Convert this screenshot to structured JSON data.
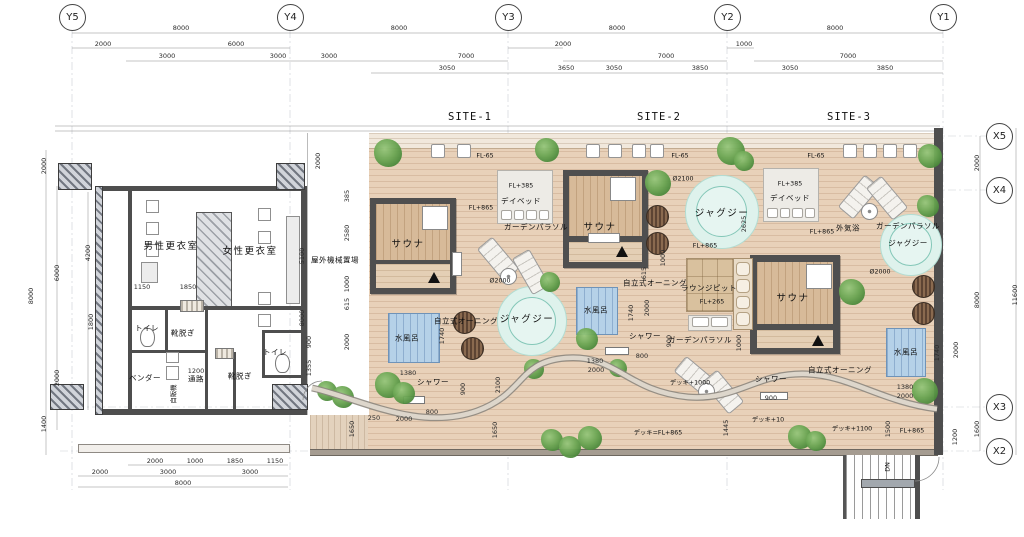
{
  "colors": {
    "deck": "#e8d1b9",
    "wall": "#4e4e4e",
    "pool": "#b5d1e8",
    "jacuzzi": "#def2ec",
    "tree": "#5d9a47",
    "path": "#8d877f",
    "accent_wood": "#d7ba99"
  },
  "grid": {
    "y_axes": [
      {
        "label": "Y5",
        "x": 72
      },
      {
        "label": "Y4",
        "x": 290
      },
      {
        "label": "Y3",
        "x": 508
      },
      {
        "label": "Y2",
        "x": 727
      },
      {
        "label": "Y1",
        "x": 943
      }
    ],
    "x_axes": [
      {
        "label": "X5",
        "y": 136
      },
      {
        "label": "X4",
        "y": 190
      },
      {
        "label": "X3",
        "y": 407
      },
      {
        "label": "X2",
        "y": 451
      }
    ]
  },
  "sites": [
    {
      "label": "SITE-1",
      "x": 470,
      "y": 117
    },
    {
      "label": "SITE-2",
      "x": 659,
      "y": 117
    },
    {
      "label": "SITE-3",
      "x": 849,
      "y": 117
    }
  ],
  "dims": [
    {
      "t": "8000",
      "x": 181,
      "y": 28
    },
    {
      "t": "8000",
      "x": 399,
      "y": 28
    },
    {
      "t": "8000",
      "x": 617,
      "y": 28
    },
    {
      "t": "8000",
      "x": 835,
      "y": 28
    },
    {
      "t": "2000",
      "x": 103,
      "y": 44
    },
    {
      "t": "6000",
      "x": 236,
      "y": 44
    },
    {
      "t": "2000",
      "x": 563,
      "y": 44
    },
    {
      "t": "1000",
      "x": 744,
      "y": 44
    },
    {
      "t": "3000",
      "x": 167,
      "y": 56
    },
    {
      "t": "3000",
      "x": 278,
      "y": 56
    },
    {
      "t": "3000",
      "x": 329,
      "y": 56
    },
    {
      "t": "7000",
      "x": 466,
      "y": 56
    },
    {
      "t": "7000",
      "x": 666,
      "y": 56
    },
    {
      "t": "7000",
      "x": 848,
      "y": 56
    },
    {
      "t": "3050",
      "x": 447,
      "y": 68
    },
    {
      "t": "3650",
      "x": 566,
      "y": 68
    },
    {
      "t": "3050",
      "x": 614,
      "y": 68
    },
    {
      "t": "3850",
      "x": 700,
      "y": 68
    },
    {
      "t": "3050",
      "x": 790,
      "y": 68
    },
    {
      "t": "3850",
      "x": 885,
      "y": 68
    },
    {
      "t": "2000",
      "x": 44,
      "y": 166,
      "r": 1
    },
    {
      "t": "6000",
      "x": 57,
      "y": 273,
      "r": 1
    },
    {
      "t": "8000",
      "x": 31,
      "y": 296,
      "r": 1
    },
    {
      "t": "2000",
      "x": 57,
      "y": 378,
      "r": 1
    },
    {
      "t": "1400",
      "x": 44,
      "y": 424,
      "r": 1
    },
    {
      "t": "4200",
      "x": 88,
      "y": 253,
      "r": 1
    },
    {
      "t": "1800",
      "x": 91,
      "y": 322,
      "r": 1
    },
    {
      "t": "5100",
      "x": 302,
      "y": 256,
      "r": 1
    },
    {
      "t": "8000",
      "x": 302,
      "y": 318,
      "r": 1
    },
    {
      "t": "900",
      "x": 309,
      "y": 342,
      "r": 1
    },
    {
      "t": "1355",
      "x": 309,
      "y": 368,
      "r": 1
    },
    {
      "t": "2000",
      "x": 318,
      "y": 161,
      "r": 1
    },
    {
      "t": "385",
      "x": 347,
      "y": 196,
      "r": 1
    },
    {
      "t": "2580",
      "x": 347,
      "y": 233,
      "r": 1
    },
    {
      "t": "1000",
      "x": 347,
      "y": 284,
      "r": 1
    },
    {
      "t": "615",
      "x": 347,
      "y": 304,
      "r": 1
    },
    {
      "t": "2000",
      "x": 347,
      "y": 342,
      "r": 1
    },
    {
      "t": "2000",
      "x": 977,
      "y": 163,
      "r": 1
    },
    {
      "t": "8000",
      "x": 977,
      "y": 300,
      "r": 1
    },
    {
      "t": "11600",
      "x": 1015,
      "y": 295,
      "r": 1
    },
    {
      "t": "1600",
      "x": 977,
      "y": 429,
      "r": 1
    },
    {
      "t": "1740",
      "x": 937,
      "y": 353,
      "r": 1
    },
    {
      "t": "2000",
      "x": 956,
      "y": 350,
      "r": 1
    },
    {
      "t": "1500",
      "x": 888,
      "y": 429,
      "r": 1
    },
    {
      "t": "1200",
      "x": 955,
      "y": 437,
      "r": 1
    },
    {
      "t": "1740",
      "x": 442,
      "y": 336,
      "r": 1
    },
    {
      "t": "1380",
      "x": 408,
      "y": 373
    },
    {
      "t": "900",
      "x": 463,
      "y": 389,
      "r": 1
    },
    {
      "t": "800",
      "x": 432,
      "y": 412
    },
    {
      "t": "250",
      "x": 374,
      "y": 418
    },
    {
      "t": "2000",
      "x": 404,
      "y": 419
    },
    {
      "t": "2100",
      "x": 498,
      "y": 385,
      "r": 1
    },
    {
      "t": "1650",
      "x": 352,
      "y": 429,
      "r": 1
    },
    {
      "t": "1650",
      "x": 495,
      "y": 430,
      "r": 1
    },
    {
      "t": "2625",
      "x": 744,
      "y": 224,
      "r": 1
    },
    {
      "t": "1000",
      "x": 663,
      "y": 258,
      "r": 1
    },
    {
      "t": "615",
      "x": 644,
      "y": 273,
      "r": 1
    },
    {
      "t": "1740",
      "x": 631,
      "y": 313,
      "r": 1
    },
    {
      "t": "2000",
      "x": 647,
      "y": 308,
      "r": 1
    },
    {
      "t": "900",
      "x": 669,
      "y": 341,
      "r": 1
    },
    {
      "t": "800",
      "x": 642,
      "y": 356
    },
    {
      "t": "1380",
      "x": 595,
      "y": 361
    },
    {
      "t": "2000",
      "x": 596,
      "y": 370
    },
    {
      "t": "900",
      "x": 771,
      "y": 398
    },
    {
      "t": "1445",
      "x": 726,
      "y": 428,
      "r": 1
    },
    {
      "t": "1000",
      "x": 739,
      "y": 343,
      "r": 1
    },
    {
      "t": "1380",
      "x": 905,
      "y": 387
    },
    {
      "t": "2000",
      "x": 905,
      "y": 396
    },
    {
      "t": "2000",
      "x": 155,
      "y": 461
    },
    {
      "t": "1000",
      "x": 195,
      "y": 461
    },
    {
      "t": "1850",
      "x": 235,
      "y": 461
    },
    {
      "t": "1150",
      "x": 275,
      "y": 461
    },
    {
      "t": "2000",
      "x": 100,
      "y": 472
    },
    {
      "t": "3000",
      "x": 168,
      "y": 472
    },
    {
      "t": "3000",
      "x": 250,
      "y": 472
    },
    {
      "t": "8000",
      "x": 183,
      "y": 483
    },
    {
      "t": "1150",
      "x": 142,
      "y": 287
    },
    {
      "t": "1850",
      "x": 188,
      "y": 287
    },
    {
      "t": "1200",
      "x": 196,
      "y": 371
    }
  ],
  "labels": [
    {
      "t": "屋外機械置場",
      "x": 335,
      "y": 260,
      "c": "small"
    },
    {
      "t": "男性更衣室",
      "x": 171,
      "y": 245,
      "c": "room"
    },
    {
      "t": "女性更衣室",
      "x": 250,
      "y": 250,
      "c": "room"
    },
    {
      "t": "トイレ",
      "x": 147,
      "y": 328,
      "c": "small"
    },
    {
      "t": "靴脱ぎ",
      "x": 183,
      "y": 333,
      "c": "small"
    },
    {
      "t": "ベンダー",
      "x": 145,
      "y": 378,
      "c": "small"
    },
    {
      "t": "通路",
      "x": 196,
      "y": 379,
      "c": "small"
    },
    {
      "t": "靴脱ぎ",
      "x": 240,
      "y": 376,
      "c": "small"
    },
    {
      "t": "トイレ",
      "x": 275,
      "y": 352,
      "c": "small"
    },
    {
      "t": "自販機",
      "x": 173,
      "y": 394,
      "c": "fl",
      "r": 1
    },
    {
      "t": "サウナ",
      "x": 408,
      "y": 243,
      "c": "room"
    },
    {
      "t": "サウナ",
      "x": 600,
      "y": 226,
      "c": "room"
    },
    {
      "t": "サウナ",
      "x": 793,
      "y": 297,
      "c": "room"
    },
    {
      "t": "水風呂",
      "x": 407,
      "y": 338,
      "c": "small"
    },
    {
      "t": "水風呂",
      "x": 596,
      "y": 310,
      "c": "small"
    },
    {
      "t": "水風呂",
      "x": 906,
      "y": 352,
      "c": "small"
    },
    {
      "t": "ジャグジー",
      "x": 527,
      "y": 318,
      "c": "room"
    },
    {
      "t": "ジャグジー",
      "x": 722,
      "y": 212,
      "c": "room"
    },
    {
      "t": "ジャグジー",
      "x": 908,
      "y": 243,
      "c": "small"
    },
    {
      "t": "シャワー",
      "x": 433,
      "y": 382,
      "c": "small"
    },
    {
      "t": "シャワー",
      "x": 645,
      "y": 336,
      "c": "small"
    },
    {
      "t": "シャワー",
      "x": 771,
      "y": 379,
      "c": "small"
    },
    {
      "t": "デイベッド",
      "x": 521,
      "y": 201,
      "c": "small"
    },
    {
      "t": "デイベッド",
      "x": 790,
      "y": 198,
      "c": "small"
    },
    {
      "t": "FL+385",
      "x": 521,
      "y": 186,
      "c": "fl"
    },
    {
      "t": "FL+385",
      "x": 790,
      "y": 184,
      "c": "fl"
    },
    {
      "t": "FL+865",
      "x": 481,
      "y": 208,
      "c": "fl"
    },
    {
      "t": "FL+865",
      "x": 705,
      "y": 246,
      "c": "fl"
    },
    {
      "t": "FL+865",
      "x": 822,
      "y": 232,
      "c": "fl"
    },
    {
      "t": "FL+865",
      "x": 912,
      "y": 431,
      "c": "fl"
    },
    {
      "t": "FL+265",
      "x": 712,
      "y": 302,
      "c": "fl"
    },
    {
      "t": "FL-65",
      "x": 485,
      "y": 156,
      "c": "fl"
    },
    {
      "t": "FL-65",
      "x": 680,
      "y": 156,
      "c": "fl"
    },
    {
      "t": "FL-65",
      "x": 816,
      "y": 156,
      "c": "fl"
    },
    {
      "t": "ガーデンパラソル",
      "x": 536,
      "y": 227,
      "c": "small"
    },
    {
      "t": "ガーデンパラソル",
      "x": 700,
      "y": 340,
      "c": "small"
    },
    {
      "t": "ガーデンパラソル",
      "x": 908,
      "y": 226,
      "c": "small"
    },
    {
      "t": "自立式オーニング",
      "x": 466,
      "y": 321,
      "c": "small"
    },
    {
      "t": "自立式オーニング",
      "x": 655,
      "y": 283,
      "c": "small"
    },
    {
      "t": "自立式オーニング",
      "x": 840,
      "y": 370,
      "c": "small"
    },
    {
      "t": "ラウンジピット",
      "x": 709,
      "y": 288,
      "c": "small"
    },
    {
      "t": "外気浴",
      "x": 848,
      "y": 228,
      "c": "small"
    },
    {
      "t": "デッキ=FL+865",
      "x": 658,
      "y": 432,
      "c": "fl"
    },
    {
      "t": "デッキ+1000",
      "x": 690,
      "y": 382,
      "c": "fl"
    },
    {
      "t": "デッキ+10",
      "x": 768,
      "y": 419,
      "c": "fl"
    },
    {
      "t": "デッキ+1100",
      "x": 852,
      "y": 428,
      "c": "fl"
    },
    {
      "t": "DN",
      "x": 888,
      "y": 467,
      "c": "fl",
      "r": 1
    },
    {
      "t": "Ø2000",
      "x": 500,
      "y": 281,
      "c": "fl"
    },
    {
      "t": "Ø2100",
      "x": 683,
      "y": 179,
      "c": "fl"
    },
    {
      "t": "Ø2000",
      "x": 880,
      "y": 272,
      "c": "fl"
    }
  ],
  "trees": [
    [
      388,
      153,
      14
    ],
    [
      547,
      150,
      12
    ],
    [
      658,
      183,
      13
    ],
    [
      731,
      151,
      14
    ],
    [
      744,
      161,
      10
    ],
    [
      930,
      156,
      12
    ],
    [
      928,
      206,
      11
    ],
    [
      852,
      292,
      13
    ],
    [
      550,
      282,
      10
    ],
    [
      587,
      339,
      11
    ],
    [
      618,
      368,
      9
    ],
    [
      534,
      369,
      10
    ],
    [
      327,
      391,
      10
    ],
    [
      343,
      397,
      11
    ],
    [
      388,
      385,
      13
    ],
    [
      404,
      393,
      11
    ],
    [
      552,
      440,
      11
    ],
    [
      570,
      447,
      11
    ],
    [
      590,
      438,
      12
    ],
    [
      800,
      437,
      12
    ],
    [
      816,
      441,
      10
    ],
    [
      925,
      391,
      13
    ]
  ],
  "stools": {
    "y": 150,
    "xs": [
      437,
      463,
      592,
      614,
      638,
      656,
      849,
      869,
      889,
      909
    ]
  },
  "loungers": [
    [
      497,
      258,
      -40
    ],
    [
      530,
      271,
      -30
    ],
    [
      858,
      196,
      40
    ],
    [
      886,
      197,
      -40
    ],
    [
      695,
      376,
      -50
    ],
    [
      722,
      391,
      -40
    ]
  ],
  "barrels": [
    [
      464,
      322
    ],
    [
      472,
      348
    ],
    [
      657,
      216
    ],
    [
      657,
      243
    ],
    [
      923,
      286
    ],
    [
      923,
      313
    ]
  ],
  "parasols": [
    [
      508,
      276
    ],
    [
      706,
      391
    ],
    [
      869,
      211
    ]
  ],
  "showers": [
    [
      403,
      396,
      20
    ],
    [
      605,
      347,
      22
    ],
    [
      760,
      392,
      26
    ]
  ],
  "fixtures": [
    [
      "sq",
      146,
      200,
      13,
      13
    ],
    [
      "sq",
      146,
      222,
      13,
      13
    ],
    [
      "sq",
      146,
      244,
      13,
      13
    ],
    [
      "counter",
      141,
      262,
      17,
      21
    ],
    [
      "sq",
      258,
      208,
      13,
      13
    ],
    [
      "sq",
      258,
      231,
      13,
      13
    ],
    [
      "sq",
      258,
      292,
      13,
      13
    ],
    [
      "sq",
      258,
      314,
      13,
      13
    ],
    [
      "counter",
      286,
      216,
      14,
      88
    ],
    [
      "mat",
      180,
      300,
      22,
      10
    ],
    [
      "mat",
      215,
      348,
      17,
      9
    ],
    [
      "wc",
      140,
      328,
      13,
      17
    ],
    [
      "wc",
      275,
      354,
      13,
      17
    ],
    [
      "sq",
      166,
      352,
      13,
      11
    ],
    [
      "sq",
      166,
      366,
      13,
      14
    ],
    [
      "shelf",
      588,
      233,
      30,
      8
    ],
    [
      "shelf",
      452,
      252,
      8,
      22
    ]
  ]
}
